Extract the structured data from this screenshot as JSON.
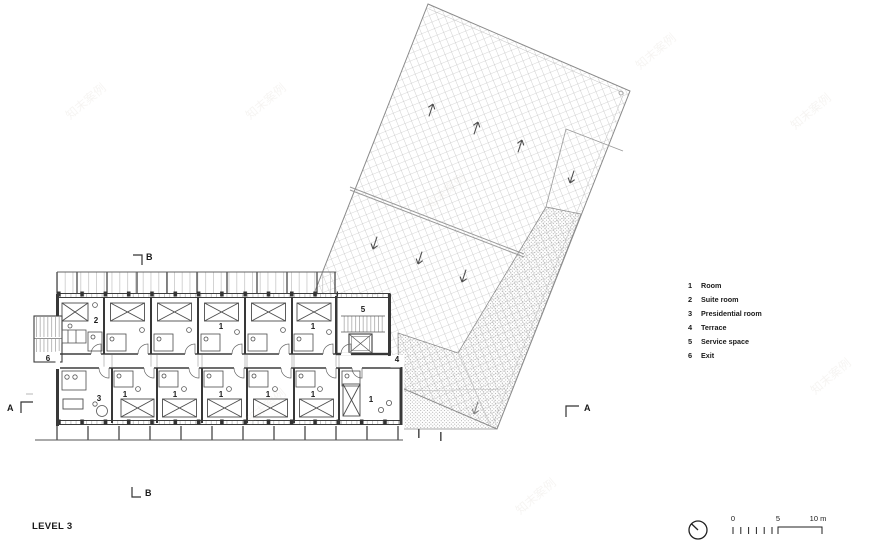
{
  "title": {
    "level": "LEVEL 3"
  },
  "legend": {
    "items": [
      {
        "num": "1",
        "label": "Room"
      },
      {
        "num": "2",
        "label": "Suite room"
      },
      {
        "num": "3",
        "label": "Presidential room"
      },
      {
        "num": "4",
        "label": "Terrace"
      },
      {
        "num": "5",
        "label": "Service space"
      },
      {
        "num": "6",
        "label": "Exit"
      }
    ]
  },
  "plan": {
    "labels": [
      {
        "text": "2"
      },
      {
        "text": "1"
      },
      {
        "text": "1"
      },
      {
        "text": "3"
      },
      {
        "text": "1"
      },
      {
        "text": "1"
      },
      {
        "text": "1"
      },
      {
        "text": "1"
      },
      {
        "text": "1"
      },
      {
        "text": "1"
      },
      {
        "text": "5"
      },
      {
        "text": "4"
      },
      {
        "text": "6"
      }
    ]
  },
  "sections": {
    "a": "A",
    "b": "B"
  },
  "scale": {
    "zero": "0",
    "five": "5",
    "ten": "10 m"
  },
  "icons": {
    "north": "north-indicator-icon",
    "compass_shape": "circle-with-northwest-needle"
  },
  "watermark": {
    "text": "知末案例"
  },
  "colors": {
    "wall": "#383838",
    "line": "#555555",
    "hatch": "#b0b0b0",
    "stipple": "#909090",
    "text": "#1a1a1a"
  }
}
